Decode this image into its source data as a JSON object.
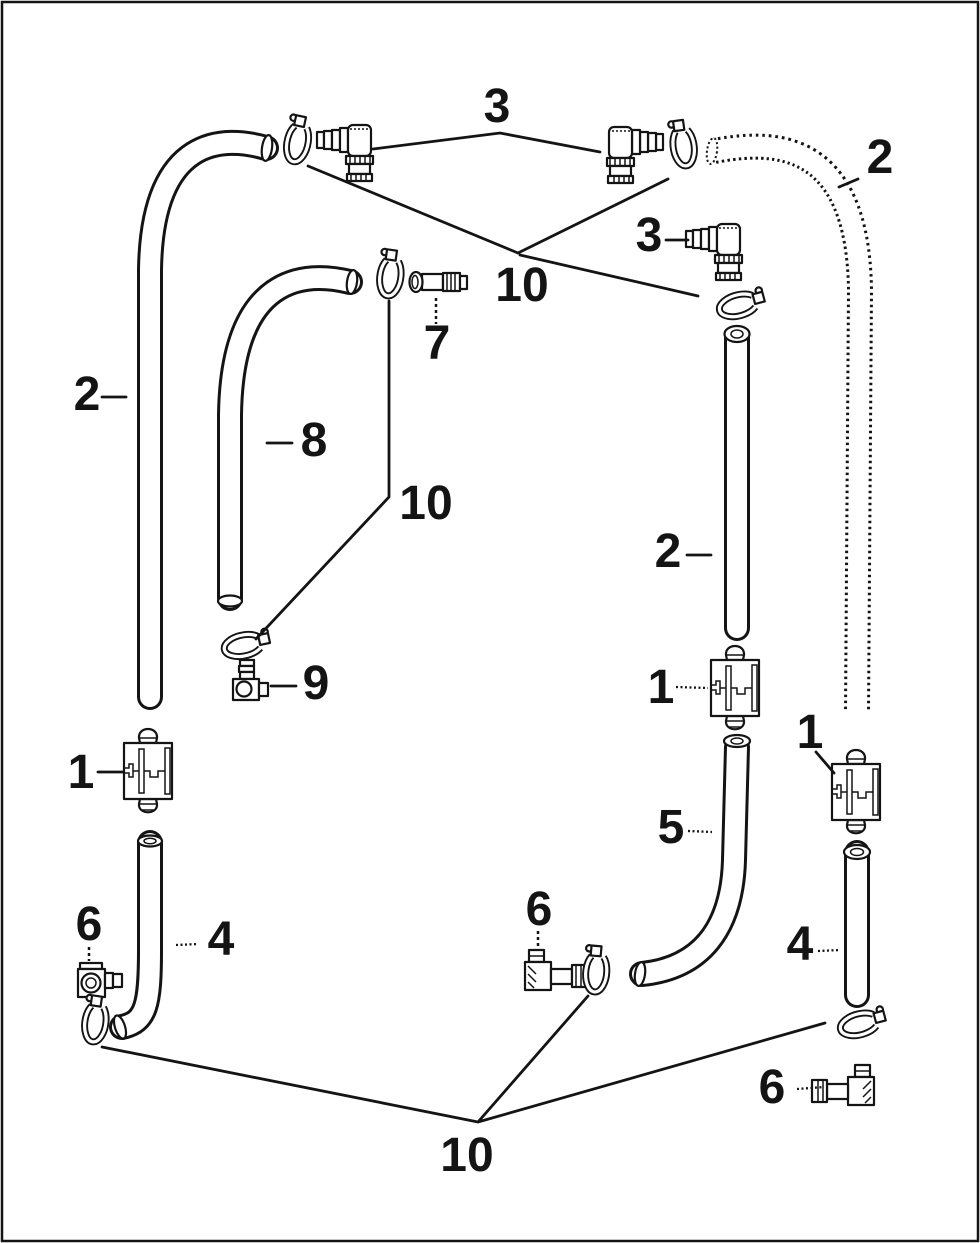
{
  "diagram": {
    "background_color": "#ffffff",
    "line_color": "#141414",
    "description_labels": "numeric part callouts of an exploded hose and fitting parts diagram",
    "callouts": {
      "top_3": "3",
      "top_10": "10",
      "right_2": "2",
      "mid_right_3": "3",
      "item_7": "7",
      "left_2": "2",
      "item_8": "8",
      "mid_10": "10",
      "center_2": "2",
      "right_1a": "1",
      "item_9": "9",
      "right_1b": "1",
      "left_1": "1",
      "item_5": "5",
      "left_6": "6",
      "left_4": "4",
      "mid_6": "6",
      "right_4": "4",
      "right_6": "6",
      "bottom_10": "10"
    }
  }
}
